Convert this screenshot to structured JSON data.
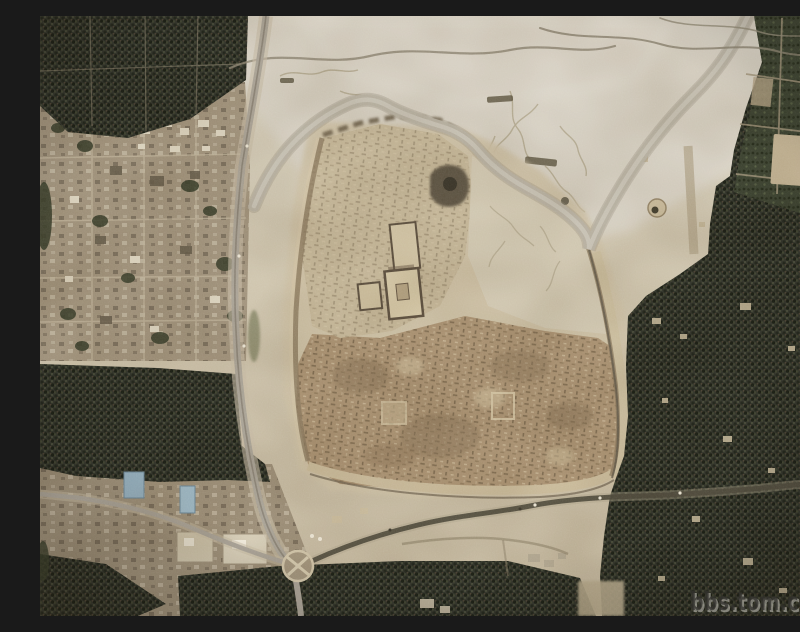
{
  "meta": {
    "width": 800,
    "height": 600,
    "kind": "satellite photograph"
  },
  "scene": {
    "description": "Satellite photo of a large square walled archaeological ruin mound beside a village; a winding dry river channel wraps its north-east side; pale desert above, dense date-palm groves east and south, roads meeting at a roundabout with a cross marking",
    "features": {
      "ruins_mound": "walled archaeological mound with excavated temple complex",
      "river_channel": "winding pale dry channel",
      "palm_grove_east": "dense date-palm grove",
      "orchard_grid": "gridded orchard plots (north-east)",
      "village_west": "village blocks with small buildings",
      "roundabout": "traffic circle with cross marking",
      "desert_north": "pale eroded desert ground"
    }
  },
  "watermark": {
    "text": "bbs.tom.com"
  },
  "palette": {
    "sand": "#d3cab4",
    "desert_pale": "#d9d3c6",
    "mound_upper": "#c6b89a",
    "mound_ruins": "#ab9373",
    "grove": "#32342a",
    "channel": "#b9b3a4",
    "road_dark": "#4f4a3c",
    "road_gray": "#a9a296",
    "village": "#a2947d",
    "blue_roof": "#9db8c6",
    "watermark_dark": "#34332f",
    "watermark_light": "#d6d4cc"
  }
}
